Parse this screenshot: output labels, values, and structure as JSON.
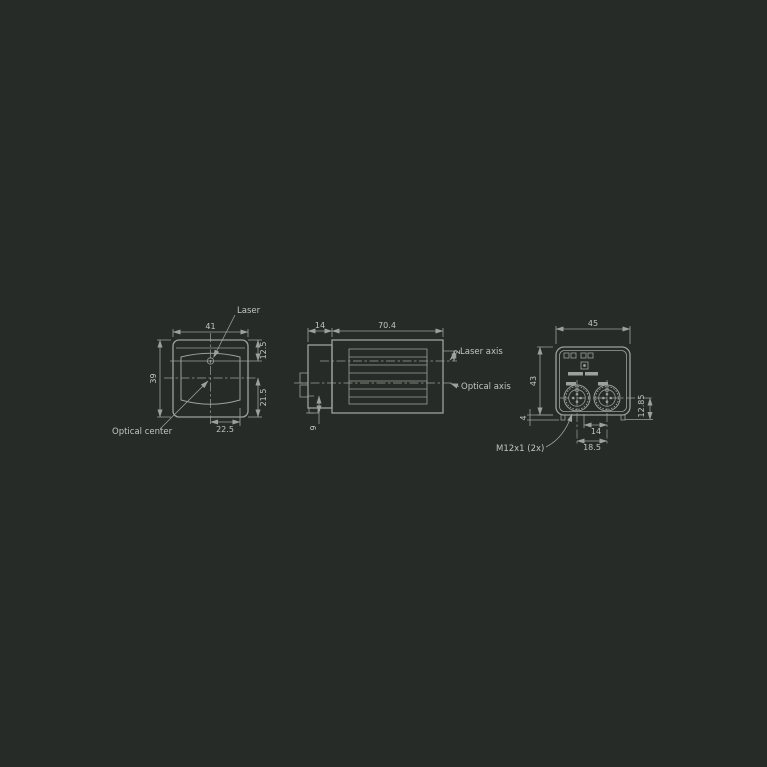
{
  "colors": {
    "background": "#272b27",
    "line": "#9ba19b",
    "text": "#bfc5bf"
  },
  "drawing": {
    "front_view": {
      "dim_width": "41",
      "dim_height": "39",
      "dim_laser_offset": "12.5",
      "dim_optical_offset": "21.5",
      "dim_horizontal_offset": "22.5",
      "label_laser": "Laser",
      "label_optical_center": "Optical center"
    },
    "side_view": {
      "dim_front_section": "14",
      "dim_body_length": "70.4",
      "dim_axis_gap": "2",
      "dim_bottom_offset": "9",
      "label_laser_axis": "Laser axis",
      "label_optical_axis": "Optical axis"
    },
    "rear_view": {
      "dim_width": "45",
      "dim_height": "43",
      "dim_connector_gap": "14",
      "dim_connector_spacing": "18.5",
      "dim_connector_height": "12.85",
      "dim_tab": "4",
      "label_connector_thread": "M12x1 (2x)"
    }
  }
}
